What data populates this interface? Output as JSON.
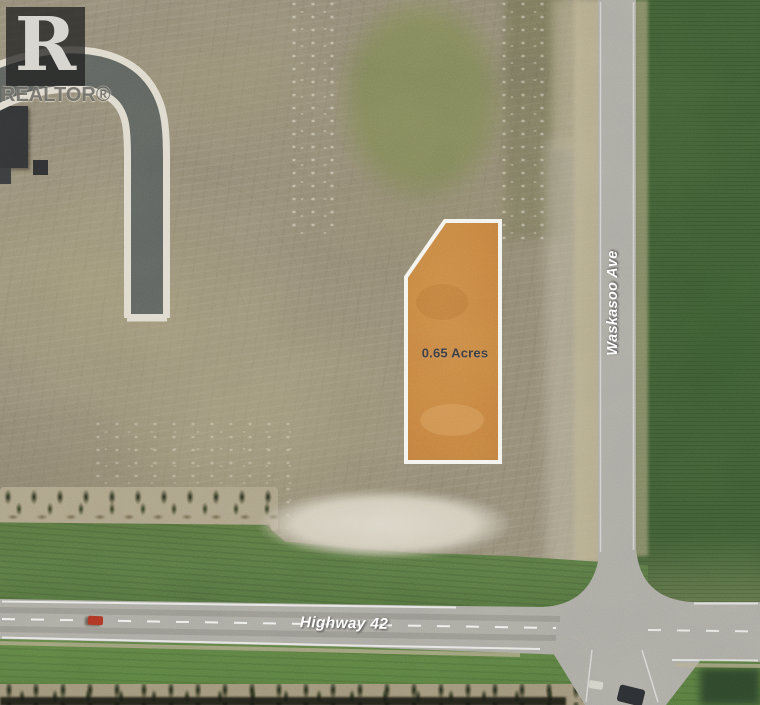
{
  "scene": {
    "type": "aerial-property-photo",
    "watermark": {
      "letter": "R",
      "label": "REALTOR®"
    },
    "parcel": {
      "area_label": "0.65 Acres",
      "fill_color": "#c8803e",
      "outline_color": "#ffffff",
      "label_text_color": "#3d4046"
    },
    "roads": {
      "vertical_road_label": "Waskasoo Ave",
      "highway_label": "Highway 42",
      "label_text_color": "#ffffff"
    },
    "colors": {
      "dirt": "#8d8573",
      "olive_field": "#7b8158",
      "dark_green_field": "#3c5a33",
      "grass": "#55723f",
      "pavement": "#a6a5a0",
      "new_subdivision_road": "#5a5f5d",
      "sand_patch": "#d5d0c2"
    }
  }
}
